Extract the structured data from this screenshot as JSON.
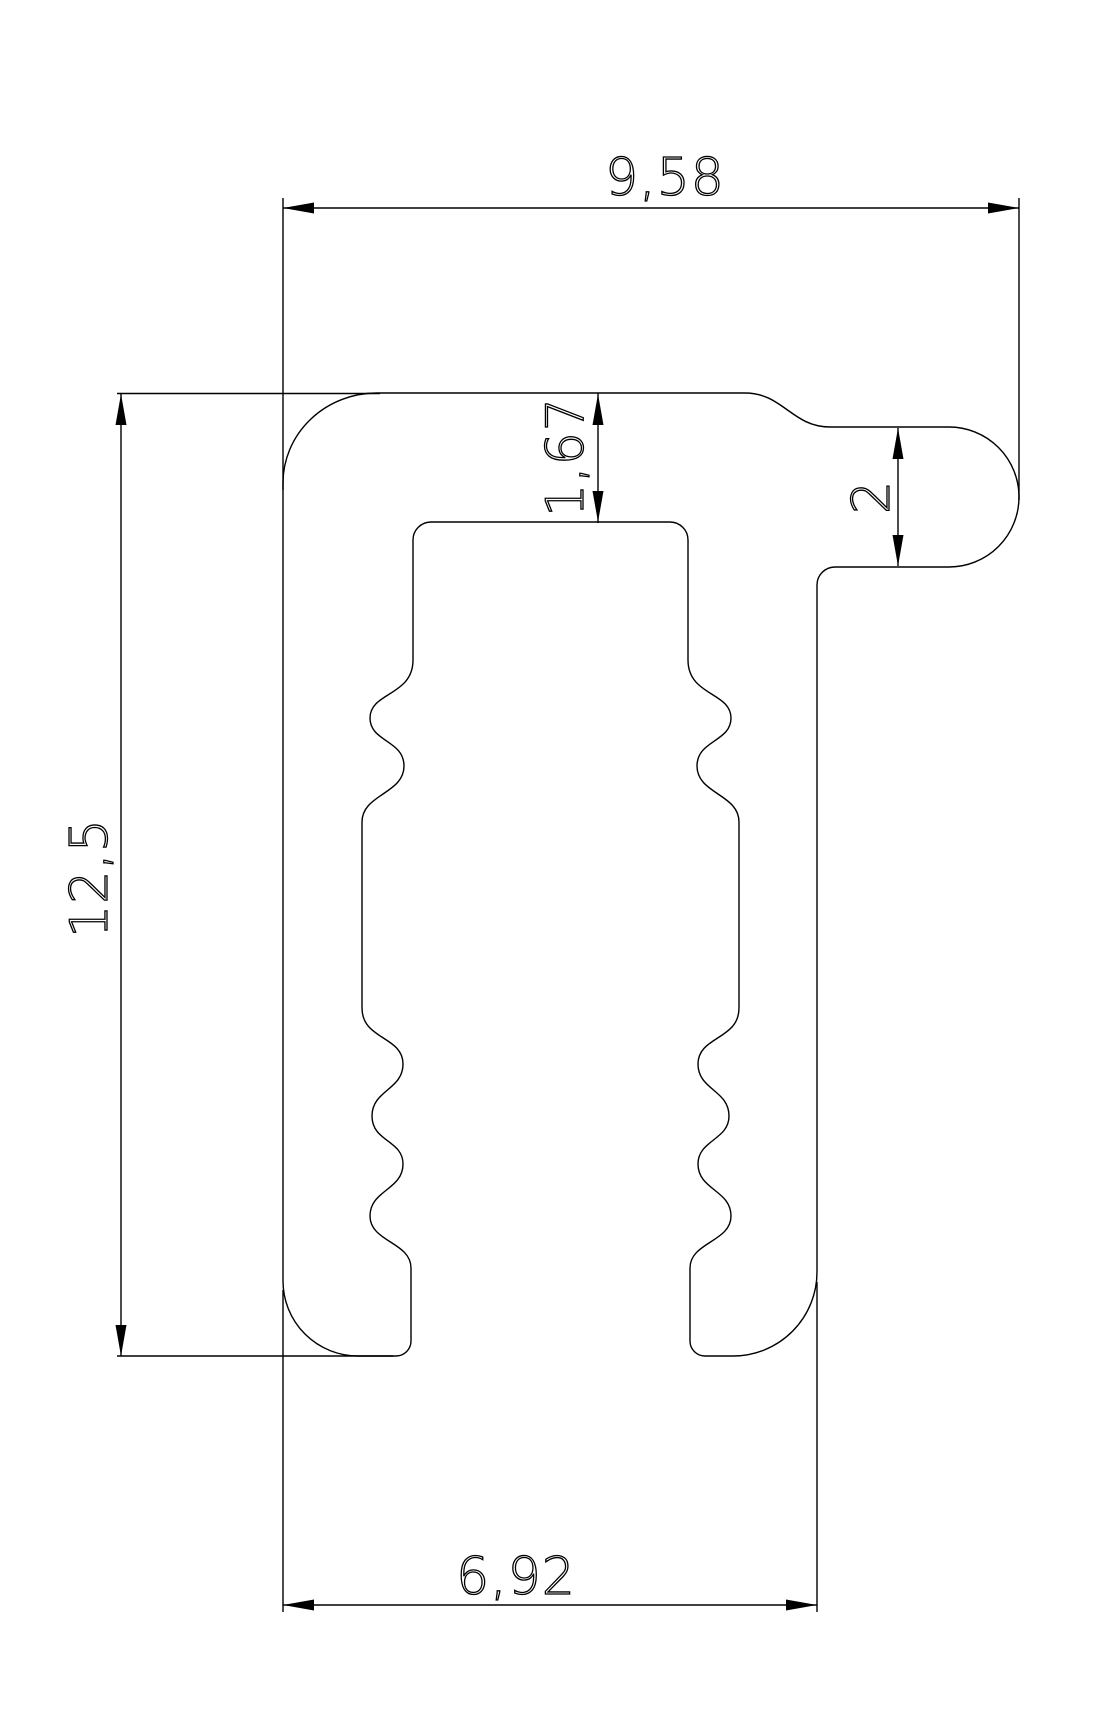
{
  "drawing": {
    "background": "#ffffff",
    "line_color": "#000000",
    "dimensions": {
      "top_width": {
        "label": "9,58",
        "value": 9.58,
        "orientation": "horizontal"
      },
      "overall_height": {
        "label": "12,5",
        "value": 12.5,
        "orientation": "vertical"
      },
      "groove_top_offset": {
        "label": "1,67",
        "value": 1.67,
        "orientation": "vertical"
      },
      "side_tab_height": {
        "label": "2",
        "value": 2,
        "orientation": "vertical"
      },
      "bottom_width": {
        "label": "6,92",
        "value": 6.92,
        "orientation": "horizontal"
      }
    }
  }
}
